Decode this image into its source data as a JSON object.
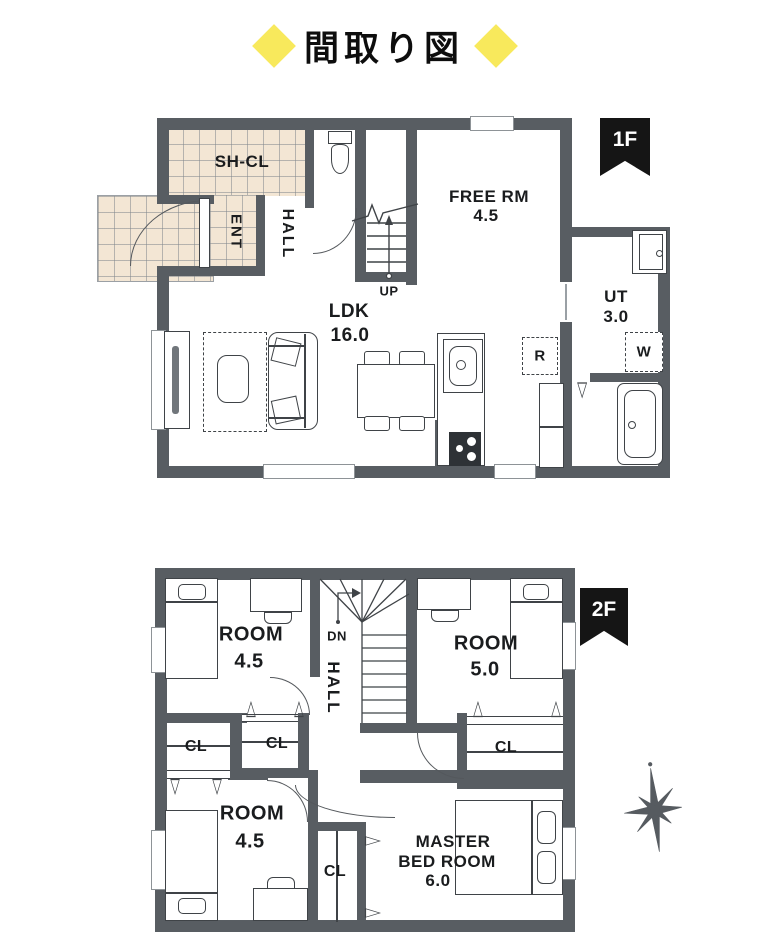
{
  "title": "間取り図",
  "f1": {
    "flag": "1F",
    "shcl": "SH-CL",
    "ent": "ENT",
    "hall": "HALL",
    "up": "UP",
    "free_name": "FREE RM",
    "free_size": "4.5",
    "ldk_name": "LDK",
    "ldk_size": "16.0",
    "ut_name": "UT",
    "ut_size": "3.0",
    "fridge": "R",
    "washer": "W"
  },
  "f2": {
    "flag": "2F",
    "dn": "DN",
    "hall": "HALL",
    "room_nw_name": "ROOM",
    "room_nw_size": "4.5",
    "room_ne_name": "ROOM",
    "room_ne_size": "5.0",
    "room_sw_name": "ROOM",
    "room_sw_size": "4.5",
    "master_1": "MASTER",
    "master_2": "BED ROOM",
    "master_size": "6.0",
    "cl_w": "CL",
    "cl_m": "CL",
    "cl_e": "CL",
    "cl_s": "CL"
  },
  "colors": {
    "wall": "#585d62",
    "tile": "#f3e6d4",
    "accent_yellow": "#f8e95c",
    "flag_black": "#151515",
    "line": "#3f4347"
  }
}
